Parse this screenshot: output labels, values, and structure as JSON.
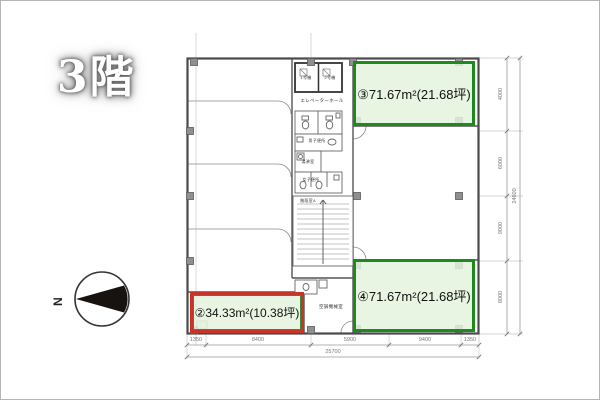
{
  "page": {
    "floor_label": "3階",
    "compass_label": "N"
  },
  "units": {
    "unit2": {
      "label": "②34.33m²(10.38坪)",
      "border_color": "#c8342a"
    },
    "unit3": {
      "label": "③71.67m²(21.68坪)",
      "border_color": "#1e8a1e"
    },
    "unit4": {
      "label": "④71.67m²(21.68坪)",
      "border_color": "#1e8a1e"
    }
  },
  "core": {
    "elevator_hall": "エレベーターホール",
    "elevator_1": "1号機",
    "elevator_2": "2号機",
    "mens_toilet": "男子便所",
    "kitchenette": "湯沸室",
    "womens_toilet": "女子便所",
    "stairwell": "階段室A",
    "machine_room": "空調機械室"
  },
  "dimensions": {
    "bottom_segments": [
      "1350",
      "8400",
      "5900",
      "9400",
      "1350"
    ],
    "bottom_total": "25700",
    "right_segments": [
      "4000",
      "6000",
      "9000",
      "8000"
    ],
    "right_total": "24600"
  },
  "colors": {
    "unit_green": "#1e8a1e",
    "unit_red": "#c8342a",
    "unit_fill": "#e7f3e2",
    "wall_gray": "#4a4a4a"
  }
}
